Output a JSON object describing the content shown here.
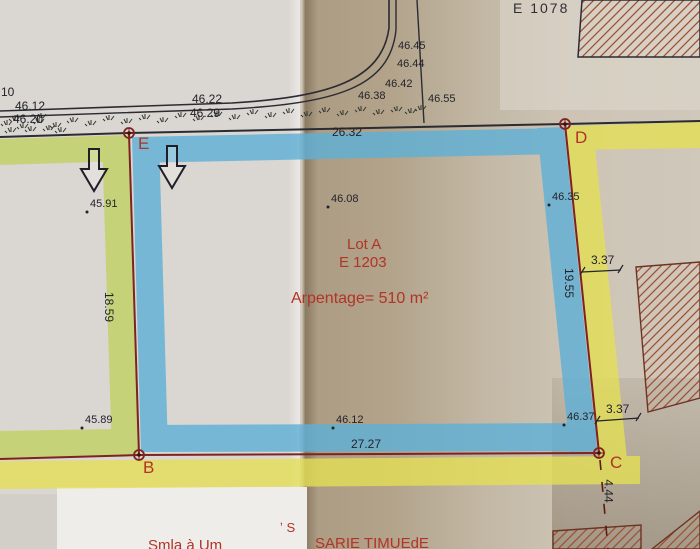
{
  "lot": {
    "name": "Lot A",
    "parcel_id": "E 1203",
    "area_label": "Arpentage= 510 m²"
  },
  "neighbor": {
    "parcel_id": "E 1078"
  },
  "corners": {
    "b": "B",
    "c": "C",
    "d": "D",
    "e": "E"
  },
  "dims": {
    "top": "26.32",
    "left": "18.59",
    "right": "19.55",
    "bottom": "27.27",
    "offset_top": "3.37",
    "offset_bottom": "3.37",
    "below_c": "4.44"
  },
  "road": {
    "n10": "10",
    "e1": "46.12",
    "e2": "46.20",
    "e3": "46.22",
    "e4": "46.29",
    "e5": "46.45",
    "e6": "46.44",
    "e7": "46.42",
    "e8": "46.38",
    "e9": "46.55"
  },
  "spots": {
    "s1": "45.91",
    "s2": "46.08",
    "s3": "46.35",
    "s4": "45.89",
    "s5": "46.12",
    "s6": "46.37"
  },
  "fragments": {
    "tick_s": "ʼ S",
    "clipped_left": "Smla à Um",
    "clipped_right": "SARIE TIMUEdE"
  },
  "colors": {
    "highlight_blue": "#5fb0d6",
    "highlight_green": "#c1d26b",
    "highlight_yellow": "#e3de55",
    "boundary_red": "#7e2222",
    "label_red": "#b23327",
    "hatch_brown": "#a04f33"
  }
}
